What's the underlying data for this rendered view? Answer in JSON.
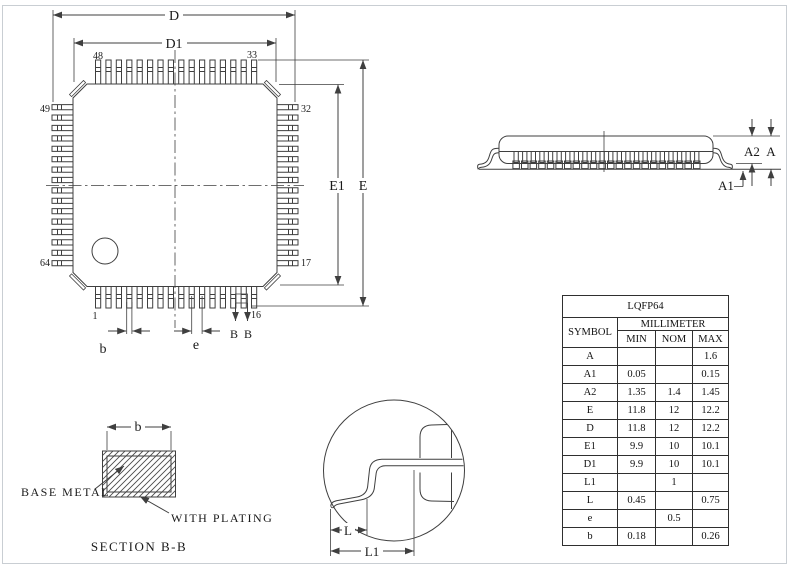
{
  "drawing": {
    "top_view": {
      "pins_per_side": 16,
      "dim_d": "D",
      "dim_d1": "D1",
      "dim_e": "E",
      "dim_e1": "E1",
      "dim_b": "b",
      "dim_pitch": "e",
      "section_b_left": "B",
      "section_b_right": "B",
      "pin_48": "48",
      "pin_33": "33",
      "pin_49": "49",
      "pin_32": "32",
      "pin_64": "64",
      "pin_17": "17",
      "pin_1": "1",
      "pin_16": "16"
    },
    "side_view": {
      "lead_count": 22,
      "dim_a": "A",
      "dim_a1": "A1",
      "dim_a2": "A2"
    },
    "section_view": {
      "dim_b": "b",
      "base_metal_label": "BASE METAL",
      "with_plating_label": "WITH PLATING",
      "caption": "SECTION B-B"
    },
    "detail_view": {
      "dim_l": "L",
      "dim_l1": "L1"
    }
  },
  "table": {
    "title": "LQFP64",
    "symbol_header": "SYMBOL",
    "unit_header": "MILLIMETER",
    "col_min": "MIN",
    "col_nom": "NOM",
    "col_max": "MAX",
    "rows": [
      {
        "symbol": "A",
        "min": "",
        "nom": "",
        "max": "1.6"
      },
      {
        "symbol": "A1",
        "min": "0.05",
        "nom": "",
        "max": "0.15"
      },
      {
        "symbol": "A2",
        "min": "1.35",
        "nom": "1.4",
        "max": "1.45"
      },
      {
        "symbol": "E",
        "min": "11.8",
        "nom": "12",
        "max": "12.2"
      },
      {
        "symbol": "D",
        "min": "11.8",
        "nom": "12",
        "max": "12.2"
      },
      {
        "symbol": "E1",
        "min": "9.9",
        "nom": "10",
        "max": "10.1"
      },
      {
        "symbol": "D1",
        "min": "9.9",
        "nom": "10",
        "max": "10.1"
      },
      {
        "symbol": "L1",
        "min": "",
        "nom": "1",
        "max": ""
      },
      {
        "symbol": "L",
        "min": "0.45",
        "nom": "",
        "max": "0.75"
      },
      {
        "symbol": "e",
        "min": "",
        "nom": "0.5",
        "max": ""
      },
      {
        "symbol": "b",
        "min": "0.18",
        "nom": "",
        "max": "0.26"
      }
    ]
  },
  "colors": {
    "line": "#3f3f3f",
    "text": "#1a1a1a",
    "frame": "#c9ced3",
    "background": "#ffffff"
  }
}
